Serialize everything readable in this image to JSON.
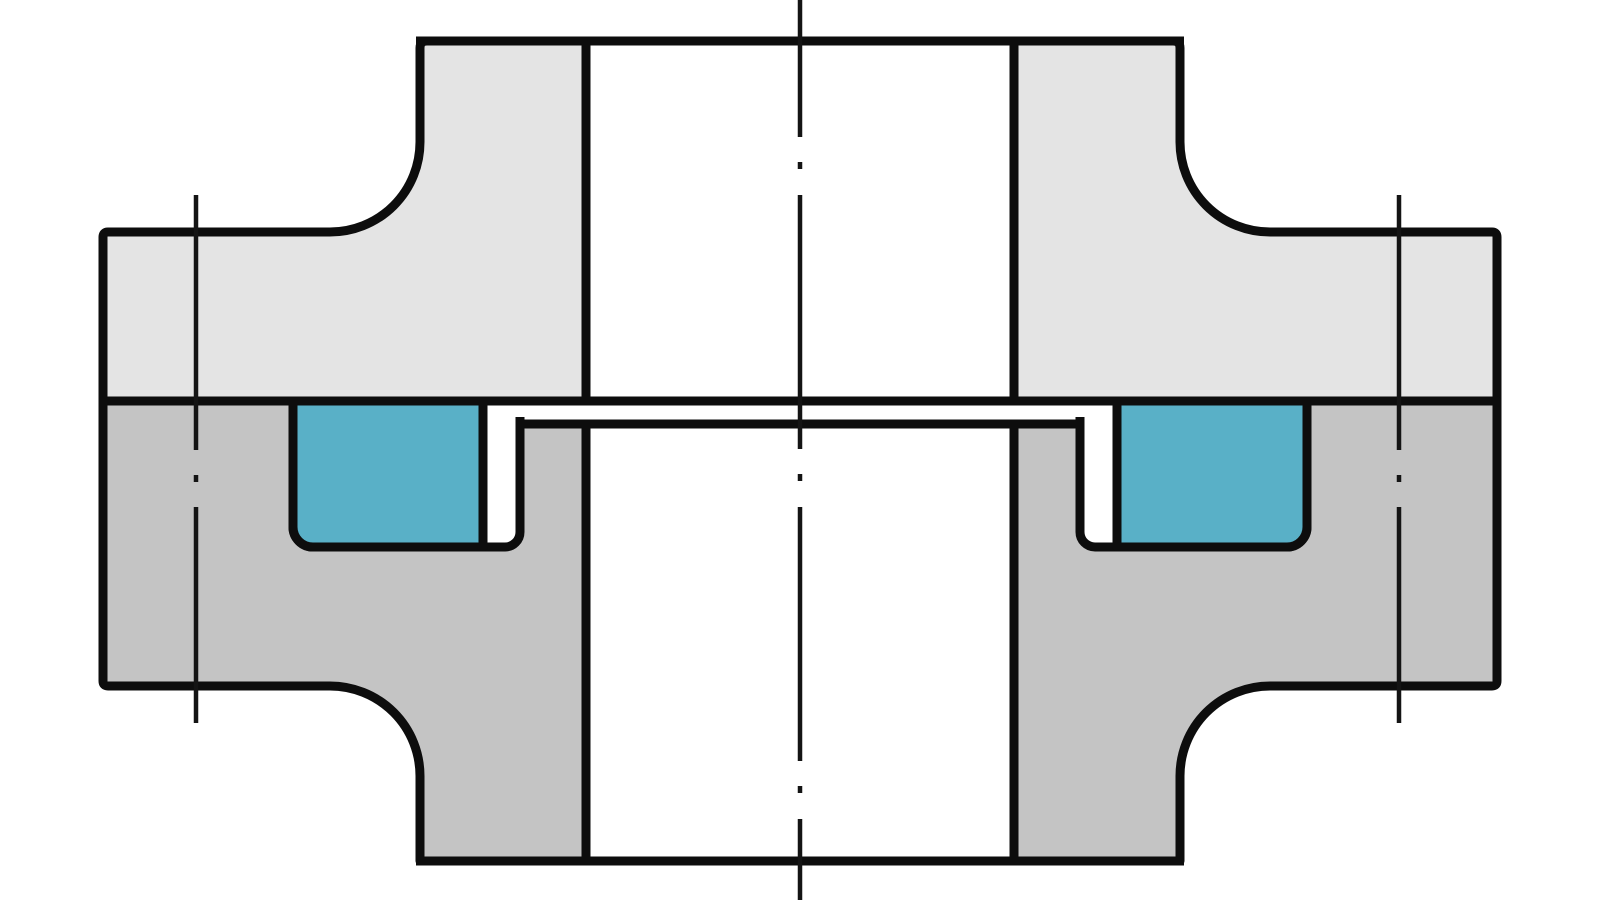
{
  "diagram": {
    "kind": "flange-joint-cross-section",
    "description": "Sectional technical drawing of a bolted flange connection: upper flat-faced flange, lower flange with recessed face and two seal grooves holding rectangular elastomer gaskets, with centre axis and two bolt axes drawn as dash-dot lines",
    "colors": {
      "background": "#ffffff",
      "outline": "#0d0d0d",
      "centerline": "#141414",
      "upper_flange": "#e4e4e4",
      "lower_flange": "#c4c4c4",
      "gasket": "#59b0c7"
    },
    "stroke_widths": {
      "outline": 9,
      "centerline": 4.5
    },
    "dash_patterns": {
      "center_axis": "254 25 7 26",
      "center_axis_offset": "117",
      "bolt_axis": "255 25 7 25"
    },
    "geometry": {
      "paths": {
        "upper_flange_left": "M 103 401 L 103 237 Q 103 232 108 232 L 330 232 A 90 90 0 0 0 420 142 L 420 48 Q 420 41 427 41 L 586 41 L 586 401 Z",
        "upper_flange_right": "M 1014 401 L 1014 41 L 1173 41 Q 1180 41 1180 48 L 1180 142 A 90 90 0 0 0 1270 232 L 1492 232 Q 1497 232 1497 237 L 1497 401 Z",
        "lower_flange_left": "M 103 401 L 293 401 L 293 527 A 20 20 0 0 0 313 547 L 505 547 A 15 15 0 0 0 520 532 L 520 424 L 586 424 L 586 861 L 420 861 L 420 776 A 90 90 0 0 0 330 686 L 108 686 Q 103 686 103 681 L 103 401 Z",
        "lower_flange_right": "M 1497 401 L 1307 401 L 1307 527 A 20 20 0 0 1 1287 547 L 1095 547 A 15 15 0 0 1 1080 532 L 1080 424 L 1014 424 L 1014 861 L 1180 861 L 1180 776 A 90 90 0 0 1 1270 686 L 1492 686 Q 1497 686 1497 681 L 1497 401 Z",
        "gasket_left": "M 293 401 L 483 401 L 483 547 L 313 547 A 20 20 0 0 1 293 527 Z",
        "gasket_right": "M 1307 401 L 1117 401 L 1117 547 L 1287 547 A 20 20 0 0 0 1307 527 Z"
      },
      "lines": {
        "pipe_end_face_top": "M 416 41 L 1184 41",
        "joint_face": "M 103 401 L 1497 401",
        "recess_face": "M 517 424 L 1083 424",
        "recess_stub_left": "M 520 417 L 520 428",
        "recess_stub_right": "M 1080 417 L 1080 428",
        "pipe_end_face_bottom": "M 416 861 L 1184 861",
        "center_axis": "M 800 0 L 800 900",
        "bolt_axis_left": "M 196 195 L 196 723",
        "bolt_axis_right": "M 1399 195 L 1399 723"
      }
    },
    "components": {
      "upper_flange": "upper flange half",
      "lower_flange": "lower grooved flange half",
      "gasket_left": "left seal ring",
      "gasket_right": "right seal ring",
      "center_axis": "pipe centre axis",
      "bolt_axes": "bolt hole axes"
    }
  }
}
